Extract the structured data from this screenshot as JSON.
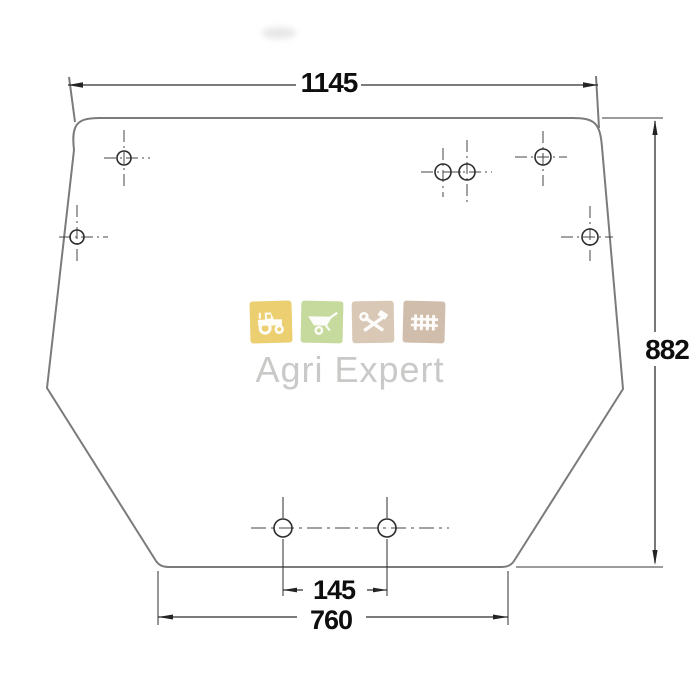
{
  "drawing": {
    "dimensions": {
      "top_width": "1145",
      "right_height": "882",
      "bottom_hole_spacing": "145",
      "bottom_width": "760"
    },
    "colors": {
      "outline": "#7b7b7b",
      "dimension": "#2e2e2e",
      "centerline": "#454545",
      "label_text": "#0e0e0e"
    }
  },
  "watermark": {
    "brand": "Agri Expert",
    "text_color": "#c9c9c7",
    "tiles": [
      {
        "icon": "tractor-icon",
        "color": "#ebcf70"
      },
      {
        "icon": "wheelbarrow-icon",
        "color": "#c7da9d"
      },
      {
        "icon": "tools-icon",
        "color": "#d9c8b6"
      },
      {
        "icon": "fence-icon",
        "color": "#d0bdac"
      }
    ]
  }
}
